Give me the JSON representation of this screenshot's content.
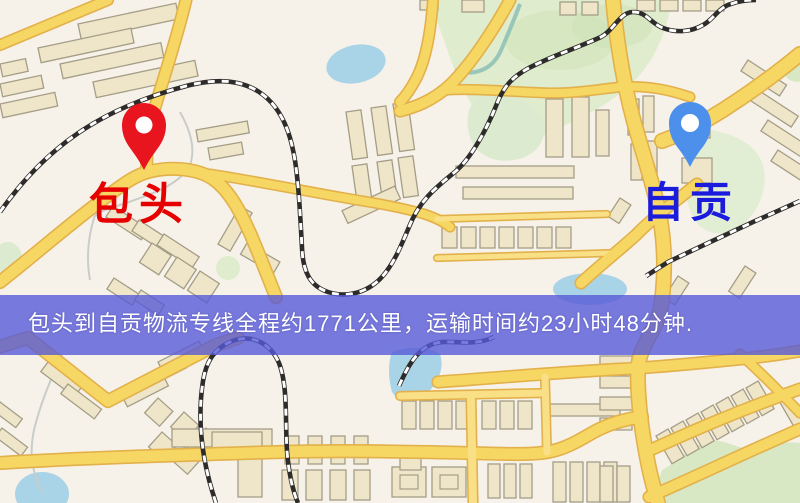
{
  "map": {
    "markers": [
      {
        "name": "origin",
        "label": "包头",
        "pin_color": "#e8141e",
        "label_color": "#e60000"
      },
      {
        "name": "destination",
        "label": "自贡",
        "pin_color": "#4d90ec",
        "label_color": "#1b1bdd"
      }
    ],
    "banner": {
      "text": "包头到自贡物流专线全程约1771公里，运输时间约23小时48分钟.",
      "background": "#585ad8",
      "text_color": "#ffffff"
    },
    "route": {
      "origin": "包头",
      "destination": "自贡",
      "distance_text": "约1771公里",
      "duration_text": "约23小时48分钟"
    },
    "colors": {
      "map_background": "#f7f2e9",
      "road": "#f7d763",
      "road_casing": "#e2b14b",
      "building": "#efe6c9",
      "building_outline": "#a49d87",
      "park": "#dfecce",
      "water": "#a9d3e7",
      "railway": "#2e2c2a"
    }
  }
}
